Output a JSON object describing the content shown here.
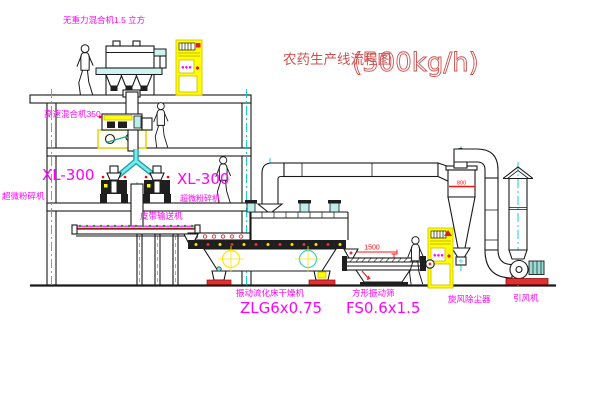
{
  "title": {
    "name": "农药生产线流程图",
    "capacity": "(500kg/h)"
  },
  "equipment": {
    "gravity_mixer": {
      "label": "无重力混合机1.5 立方"
    },
    "high_speed_mixer": {
      "label": "高速混合机350"
    },
    "pulverizer_left": {
      "model": "XL-300",
      "name": "超微粉碎机"
    },
    "pulverizer_right": {
      "model": "XL-300",
      "name": "超微粉碎机"
    },
    "belt_conveyor": {
      "label": "皮带输送机"
    },
    "fluid_bed_dryer": {
      "name": "振动流化床干燥机",
      "model": "ZLG6x0.75"
    },
    "vibrating_screen": {
      "name": "方形振动筛",
      "model": "FS0.6x1.5"
    },
    "cyclone": {
      "label": "旋风除尘器"
    },
    "fan": {
      "label": "引风机"
    }
  },
  "dimensions": {
    "screen_length": "1500",
    "screen_height": "345",
    "cyclone_diameter": "800"
  },
  "control_panel": {
    "indicator": "●●●"
  },
  "colors": {
    "label_magenta": "#ff00ff",
    "title_red": "#d05050",
    "dimension_red": "#ff1111",
    "centerline_cyan": "#00cccc",
    "highlight_yellow": "#ffff00",
    "line_black": "#1a1a1a",
    "background": "#ffffff"
  }
}
